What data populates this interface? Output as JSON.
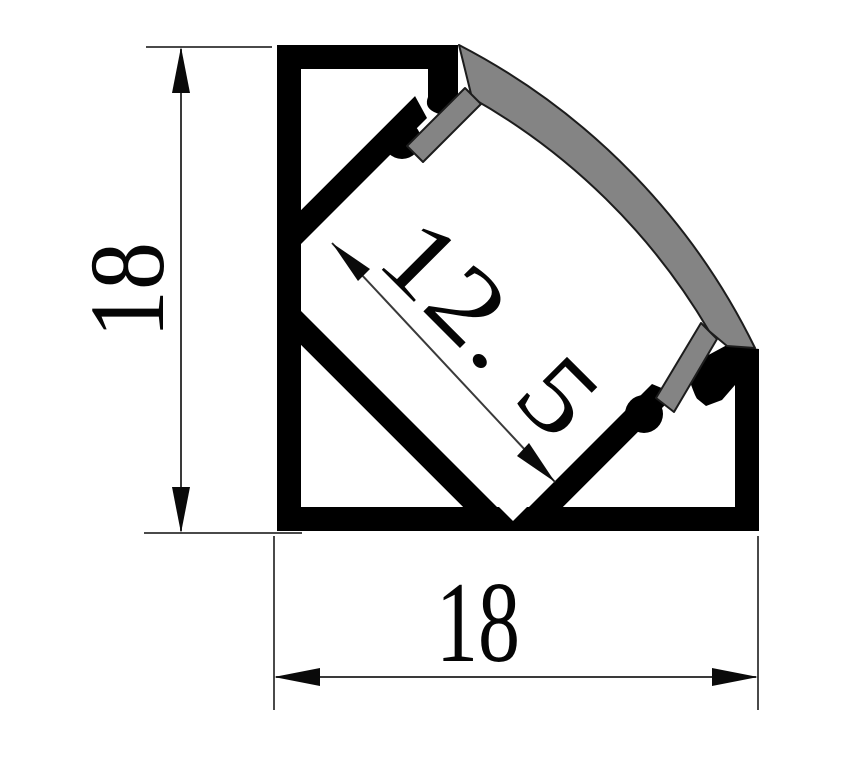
{
  "drawing": {
    "title": "LED aluminum corner profile cross-section",
    "labels": {
      "height": "18",
      "width": "18",
      "channel": "12. 5"
    },
    "colors": {
      "profile": "#000000",
      "cavity": "#ffffff",
      "diffuser": "#848484",
      "dimension_line": "#3a3a3a",
      "background": "#ffffff"
    }
  }
}
